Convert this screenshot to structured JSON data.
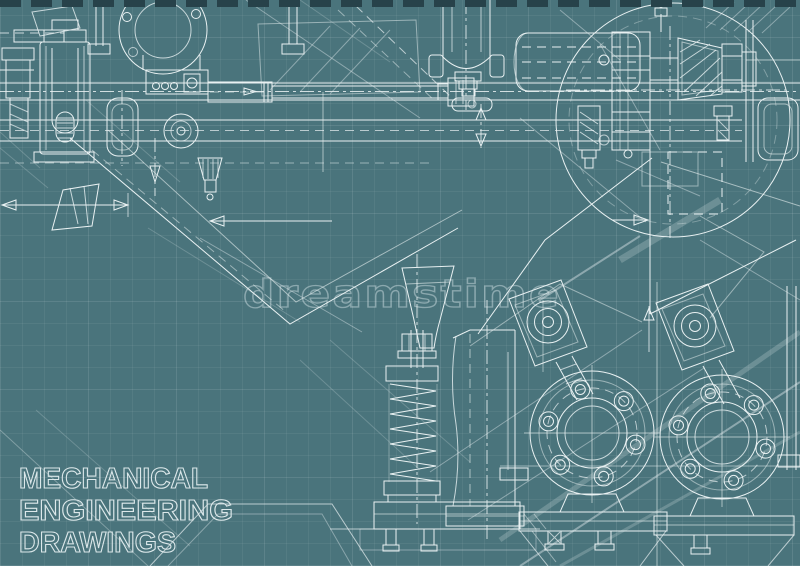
{
  "artwork": {
    "kind": "blueprint-style mechanical engineering drawing",
    "background_color": "#4a747c",
    "grid_color": "rgba(255,255,255,0.055)",
    "primary_line_color": "#e9f1f2",
    "secondary_line_color": "#bcd6da",
    "top_border_dash_color": "#27424a",
    "components": [
      "top-rails",
      "guide-cylinder",
      "top-flange-circle",
      "piston-rod-assembly",
      "trunnion-cylinder",
      "horizontal-drum",
      "detail-circle-with-gear-shaft",
      "dimension-arrows",
      "v-hopper",
      "funnel-cup",
      "coil-spring-assembly",
      "standpipe",
      "flanged-valve-left",
      "flanged-valve-right",
      "bottom-hoppers"
    ]
  },
  "watermark": {
    "text": "dreamstime"
  },
  "caption": {
    "line1": "MECHANICAL",
    "line2": "ENGINEERING",
    "line3": "DRAWINGS",
    "color": "#dce8ea"
  }
}
